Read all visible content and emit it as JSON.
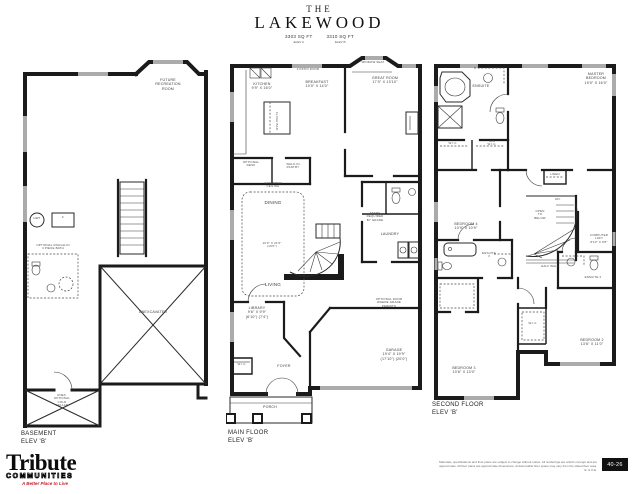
{
  "title": {
    "prefix": "THE",
    "name": "LAKEWOOD"
  },
  "variants": [
    {
      "sqft": "3303 SQ FT",
      "elev": "ELEV A"
    },
    {
      "sqft": "3310 SQ FT",
      "elev": "ELEV B"
    }
  ],
  "colors": {
    "wall": "#1b1b1b",
    "window_gray": "#ababab",
    "accent_red": "#c2202b"
  },
  "basement": {
    "future_rec": "FUTURE\nRECREATION\nROOM",
    "hwt": "HWT",
    "furnace": "F",
    "opt_bath": "OPTIONAL ROUGH-IN\n3 PIECE BATH",
    "unexcavated": "UNEXCAVATED",
    "cold_cellar": "UNEX.\nOPTIONAL\nCOLD\nCELLAR",
    "floor_name": "BASEMENT",
    "floor_elev": "ELEV 'B'"
  },
  "main_floor": {
    "kitchen": "KITCHEN\n9'9\" X 16'0\"",
    "breakfast": "BREAKFAST\n10'0\" X 14'0\"",
    "patio_door": "2 PATIO DOOR",
    "window_seat": "WINDOW SEAT",
    "great_room": "GREAT ROOM\n17'0\" X 13'10\"",
    "optional_desk": "OPTIONAL\nDESK",
    "pantry": "WALK-IN\nPANTRY",
    "island": "FLUSH BAR",
    "coffered": "COFFERED\nCEILING",
    "dining": "DINING",
    "dining_dims": "10'0\" X 21'6\"\n(19'0\")",
    "living": "LIVING",
    "steps_note": "STEPS\nREQUIRED\nBY GRADE",
    "laundry": "LAUNDRY",
    "opt_door_note": "OPTIONAL DOOR\nWHERE GRADE\nPERMITS",
    "library": "LIBRARY\n9'6\" X 9'9\"\n(6'10\") (7'4\")",
    "wic": "W.I.C.",
    "foyer": "FOYER",
    "porch": "PORCH",
    "garage": "GARAGE\n19'4\" X 19'9\"\n(17'10\") (20'0\")",
    "floor_name": "MAIN FLOOR",
    "floor_elev": "ELEV 'B'"
  },
  "second_floor": {
    "ensuite": "ENSUITE",
    "master": "MASTER\nBEDROOM\n19'0\" X 16'0\"",
    "wic_1": "W.I.C.",
    "wic_his": "HIS\nW.I.C.",
    "linen": "LINEN",
    "bedroom4": "BEDROOM 4\n10'9\" X 10'9\"",
    "ensuite3": "ENSUITE\n3",
    "dn": "DN.",
    "open_below": "OPEN\nTO\nBELOW",
    "half_wall": "HALF WALL",
    "computer_loft": "COMPUTER\nLOFT\n8'10\" X 9'8\"",
    "ensuite2": "ENSUITE 2",
    "wic_2": "W.I.C.",
    "bedroom2": "BEDROOM 2\n13'6\" X 11'0\"",
    "bedroom3": "BEDROOM 3\n10'6\" X 13'0\"",
    "floor_name": "SECOND FLOOR",
    "floor_elev": "ELEV 'B'"
  },
  "footer": {
    "brand": "Tribute",
    "brand_sub": "COMMUNITIES",
    "tagline": "A Better Place to Live",
    "disclaimer_1": "Materials, specifications and floor plans are subject to change without notice. All renderings are artist's concept and are approximate.",
    "disclaimer_2": "All floor plans are approximate dimensions. Actual usable floor space may vary from the stated floor area. E. & O.E.",
    "page": "40-26"
  }
}
